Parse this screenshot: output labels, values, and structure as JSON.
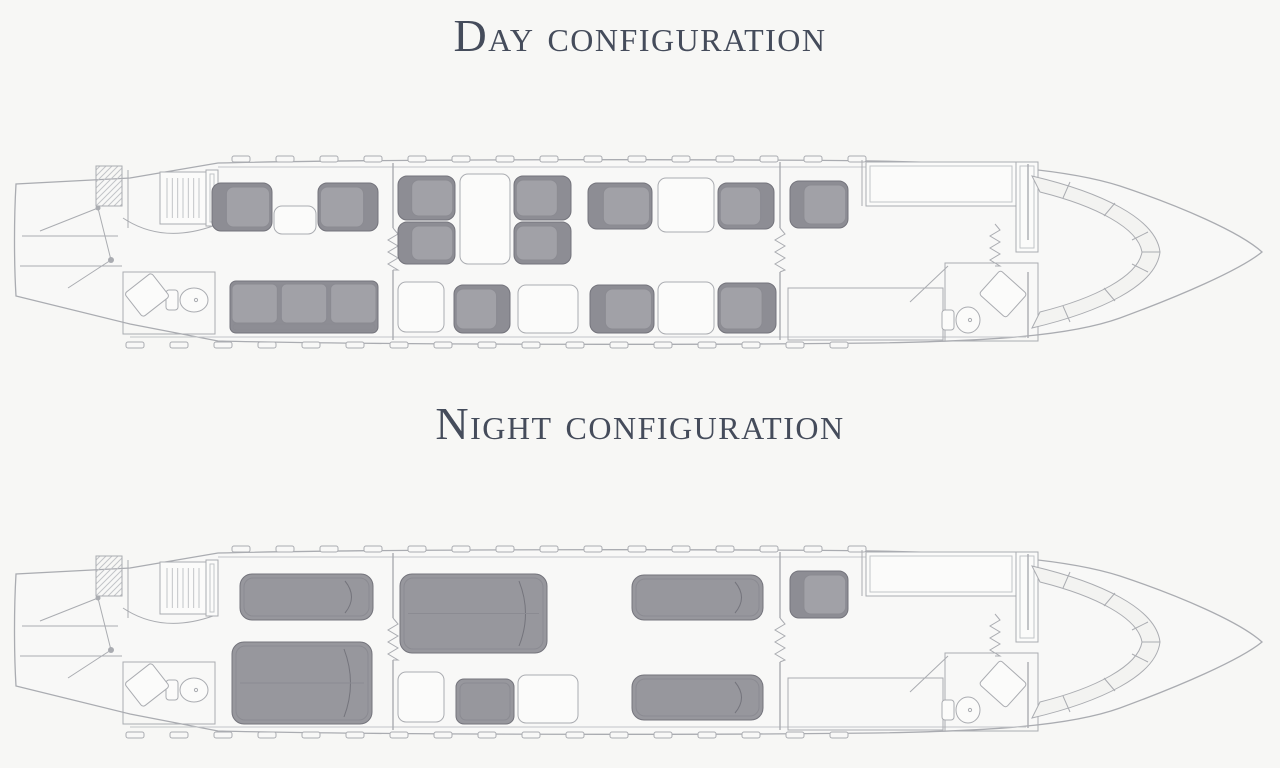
{
  "titles": {
    "day": "Day configuration",
    "night": "Night configuration"
  },
  "colors": {
    "bg": "#f7f7f5",
    "fuselage": "#f8f8f7",
    "line": "#aaacb1",
    "lineSoft": "#c2c4c8",
    "white": "#fbfbfa",
    "seatShell": "#8d8d94",
    "seatEdge": "#74747c",
    "cushion": "#a1a1a7",
    "cushionEdge": "#8b8b92",
    "bedFill": "#97979d",
    "title": "#454c5b"
  },
  "windows": {
    "top": {
      "start": 222,
      "step": 44,
      "count": 15,
      "y": 8,
      "w": 18,
      "h": 6
    },
    "bottom": {
      "start": 116,
      "step": 44,
      "count": 17,
      "y": 194,
      "w": 18,
      "h": 6
    }
  },
  "airframe": {
    "features": [
      {
        "name": "cabin-wall-top",
        "style": "softline",
        "x1": 208,
        "y1": 19,
        "x2": 1016,
        "y2": 19
      },
      {
        "name": "cabin-wall-bottom",
        "style": "softline",
        "x1": 120,
        "y1": 189,
        "x2": 1016,
        "y2": 189
      },
      {
        "name": "baggage-door-hatch",
        "style": "hatched",
        "x": 86,
        "y": 18,
        "w": 26,
        "h": 40
      },
      {
        "name": "tail-shelf-upper",
        "style": "line",
        "x1": 12,
        "y1": 88,
        "x2": 108,
        "y2": 88
      },
      {
        "name": "tail-shelf-lower",
        "style": "line",
        "x1": 10,
        "y1": 118,
        "x2": 112,
        "y2": 118
      },
      {
        "name": "airstair-strut-1",
        "style": "line",
        "x1": 88,
        "y1": 60,
        "x2": 30,
        "y2": 83
      },
      {
        "name": "airstair-strut-2",
        "style": "line",
        "x1": 88,
        "y1": 60,
        "x2": 101,
        "y2": 112
      },
      {
        "name": "airstair-strut-3",
        "style": "line",
        "x1": 101,
        "y1": 112,
        "x2": 58,
        "y2": 140
      },
      {
        "name": "airstair-hinge",
        "style": "dot",
        "cx": 88,
        "cy": 60,
        "r": 2.5
      },
      {
        "name": "airstair-hub",
        "style": "dot",
        "cx": 101,
        "cy": 112,
        "r": 3
      },
      {
        "name": "aft-partition-wall",
        "style": "line",
        "x1": 118,
        "y1": 22,
        "x2": 118,
        "y2": 80
      },
      {
        "name": "aft-lav-curved-wall",
        "style": "curve",
        "d": "M 113 70 Q 152 96 203 78"
      },
      {
        "name": "wardrobe",
        "style": "wardrobe",
        "x": 150,
        "y": 24,
        "w": 46,
        "h": 52
      },
      {
        "name": "aft-lavatory-room",
        "style": "room",
        "x": 113,
        "y": 124,
        "w": 92,
        "h": 62
      },
      {
        "name": "aft-toilet",
        "style": "toilet",
        "cx": 184,
        "cy": 152,
        "rx": 14,
        "ry": 12
      },
      {
        "name": "aft-lav-bench",
        "style": "angled",
        "x": 120,
        "y": 132,
        "w": 34,
        "h": 30,
        "rot": -38
      },
      {
        "name": "entry-console",
        "style": "counter",
        "x": 196,
        "y": 22,
        "w": 12,
        "h": 56
      },
      {
        "name": "mid-partition",
        "style": "partition",
        "x": 383,
        "y1": 15,
        "gap1": 80,
        "gap2": 122,
        "y2": 192
      },
      {
        "name": "mid-partition-curtain",
        "style": "curtain",
        "x": 383,
        "y1": 80,
        "y2": 122
      },
      {
        "name": "aft-side-table",
        "style": "table-fixed",
        "x": 388,
        "y": 134,
        "w": 46,
        "h": 50
      },
      {
        "name": "mid-credenza",
        "style": "table-fixed",
        "x": 508,
        "y": 137,
        "w": 60,
        "h": 48
      },
      {
        "name": "fwd-partition",
        "style": "partition",
        "x": 770,
        "y1": 14,
        "gap1": 80,
        "gap2": 124,
        "y2": 192
      },
      {
        "name": "fwd-partition-curtain",
        "style": "curtain",
        "x": 770,
        "y1": 80,
        "y2": 124
      },
      {
        "name": "fwd-closet-run",
        "style": "room",
        "x": 778,
        "y": 140,
        "w": 155,
        "h": 52
      },
      {
        "name": "galley-wall",
        "style": "line",
        "x1": 852,
        "y1": 12,
        "x2": 852,
        "y2": 58
      },
      {
        "name": "galley-counter",
        "style": "counter",
        "x": 856,
        "y": 14,
        "w": 150,
        "h": 44
      },
      {
        "name": "galley-cabinet",
        "style": "counter",
        "x": 1006,
        "y": 14,
        "w": 22,
        "h": 90
      },
      {
        "name": "fwd-lavatory-room",
        "style": "room",
        "x": 935,
        "y": 115,
        "w": 93,
        "h": 78
      },
      {
        "name": "fwd-lav-door",
        "style": "line",
        "x1": 900,
        "y1": 154,
        "x2": 938,
        "y2": 118
      },
      {
        "name": "fwd-toilet",
        "style": "toilet",
        "cx": 958,
        "cy": 172,
        "rx": 12,
        "ry": 13
      },
      {
        "name": "fwd-lav-vanity",
        "style": "angled",
        "x": 975,
        "y": 130,
        "w": 36,
        "h": 32,
        "rot": 42
      },
      {
        "name": "cockpit-curtain",
        "style": "curtain",
        "x": 985,
        "y1": 76,
        "y2": 118
      },
      {
        "name": "cockpit-bulkhead",
        "style": "partition",
        "x": 1018,
        "y1": 16,
        "gap1": 92,
        "gap2": 124,
        "y2": 190
      },
      {
        "name": "instrument-panel",
        "style": "cockpit"
      }
    ]
  },
  "configurations": {
    "day": {
      "items": [
        {
          "name": "aft-cabin-seat-left",
          "type": "seat",
          "x": 202,
          "y": 35,
          "w": 60,
          "h": 48,
          "facing": "fwd"
        },
        {
          "name": "aft-cabin-side-table",
          "type": "table",
          "x": 264,
          "y": 58,
          "w": 42,
          "h": 28
        },
        {
          "name": "aft-cabin-seat-right",
          "type": "seat",
          "x": 308,
          "y": 35,
          "w": 60,
          "h": 48,
          "facing": "aft"
        },
        {
          "name": "aft-divan-3-seats",
          "type": "divan",
          "x": 220,
          "y": 133,
          "w": 148,
          "h": 52,
          "cushions": 3
        },
        {
          "name": "conference-seat-aft-outboard",
          "type": "seat",
          "x": 388,
          "y": 28,
          "w": 57,
          "h": 44,
          "facing": "fwd"
        },
        {
          "name": "conference-seat-aft-inboard",
          "type": "seat",
          "x": 388,
          "y": 74,
          "w": 57,
          "h": 42,
          "facing": "fwd"
        },
        {
          "name": "conference-table",
          "type": "table",
          "x": 450,
          "y": 26,
          "w": 50,
          "h": 90
        },
        {
          "name": "conference-seat-fwd-outboard",
          "type": "seat",
          "x": 504,
          "y": 28,
          "w": 57,
          "h": 44,
          "facing": "aft"
        },
        {
          "name": "conference-seat-fwd-inboard",
          "type": "seat",
          "x": 504,
          "y": 74,
          "w": 57,
          "h": 42,
          "facing": "aft"
        },
        {
          "name": "mid-cabin-seat",
          "type": "seat",
          "x": 444,
          "y": 137,
          "w": 56,
          "h": 48,
          "facing": "aft"
        },
        {
          "name": "fwd-club-seat-aft-upper",
          "type": "seat",
          "x": 578,
          "y": 35,
          "w": 64,
          "h": 46,
          "facing": "fwd"
        },
        {
          "name": "fwd-club-table-upper",
          "type": "table",
          "x": 648,
          "y": 30,
          "w": 56,
          "h": 54
        },
        {
          "name": "fwd-club-seat-fwd-upper",
          "type": "seat",
          "x": 708,
          "y": 35,
          "w": 56,
          "h": 46,
          "facing": "aft"
        },
        {
          "name": "fwd-club-seat-aft-lower",
          "type": "seat",
          "x": 580,
          "y": 137,
          "w": 64,
          "h": 48,
          "facing": "fwd"
        },
        {
          "name": "fwd-club-table-lower",
          "type": "table",
          "x": 648,
          "y": 134,
          "w": 56,
          "h": 52
        },
        {
          "name": "fwd-club-seat-fwd-lower",
          "type": "seat",
          "x": 708,
          "y": 135,
          "w": 58,
          "h": 50,
          "facing": "aft"
        },
        {
          "name": "crew-seat",
          "type": "seat",
          "x": 780,
          "y": 33,
          "w": 58,
          "h": 47,
          "facing": "fwd"
        }
      ]
    },
    "night": {
      "items": [
        {
          "name": "aft-cabin-berth-upper",
          "type": "bed",
          "x": 230,
          "y": 36,
          "w": 133,
          "h": 46
        },
        {
          "name": "aft-cabin-berth-lower",
          "type": "bed",
          "x": 222,
          "y": 104,
          "w": 140,
          "h": 82
        },
        {
          "name": "mid-cabin-double-berth",
          "type": "bed",
          "x": 390,
          "y": 36,
          "w": 147,
          "h": 79
        },
        {
          "name": "mid-cabin-ottoman",
          "type": "ottoman",
          "x": 446,
          "y": 141,
          "w": 58,
          "h": 45
        },
        {
          "name": "fwd-cabin-berth-upper",
          "type": "bed",
          "x": 622,
          "y": 37,
          "w": 131,
          "h": 45
        },
        {
          "name": "fwd-cabin-berth-lower",
          "type": "bed",
          "x": 622,
          "y": 137,
          "w": 131,
          "h": 45
        },
        {
          "name": "crew-seat",
          "type": "seat",
          "x": 780,
          "y": 33,
          "w": 58,
          "h": 47,
          "facing": "fwd"
        }
      ]
    }
  }
}
